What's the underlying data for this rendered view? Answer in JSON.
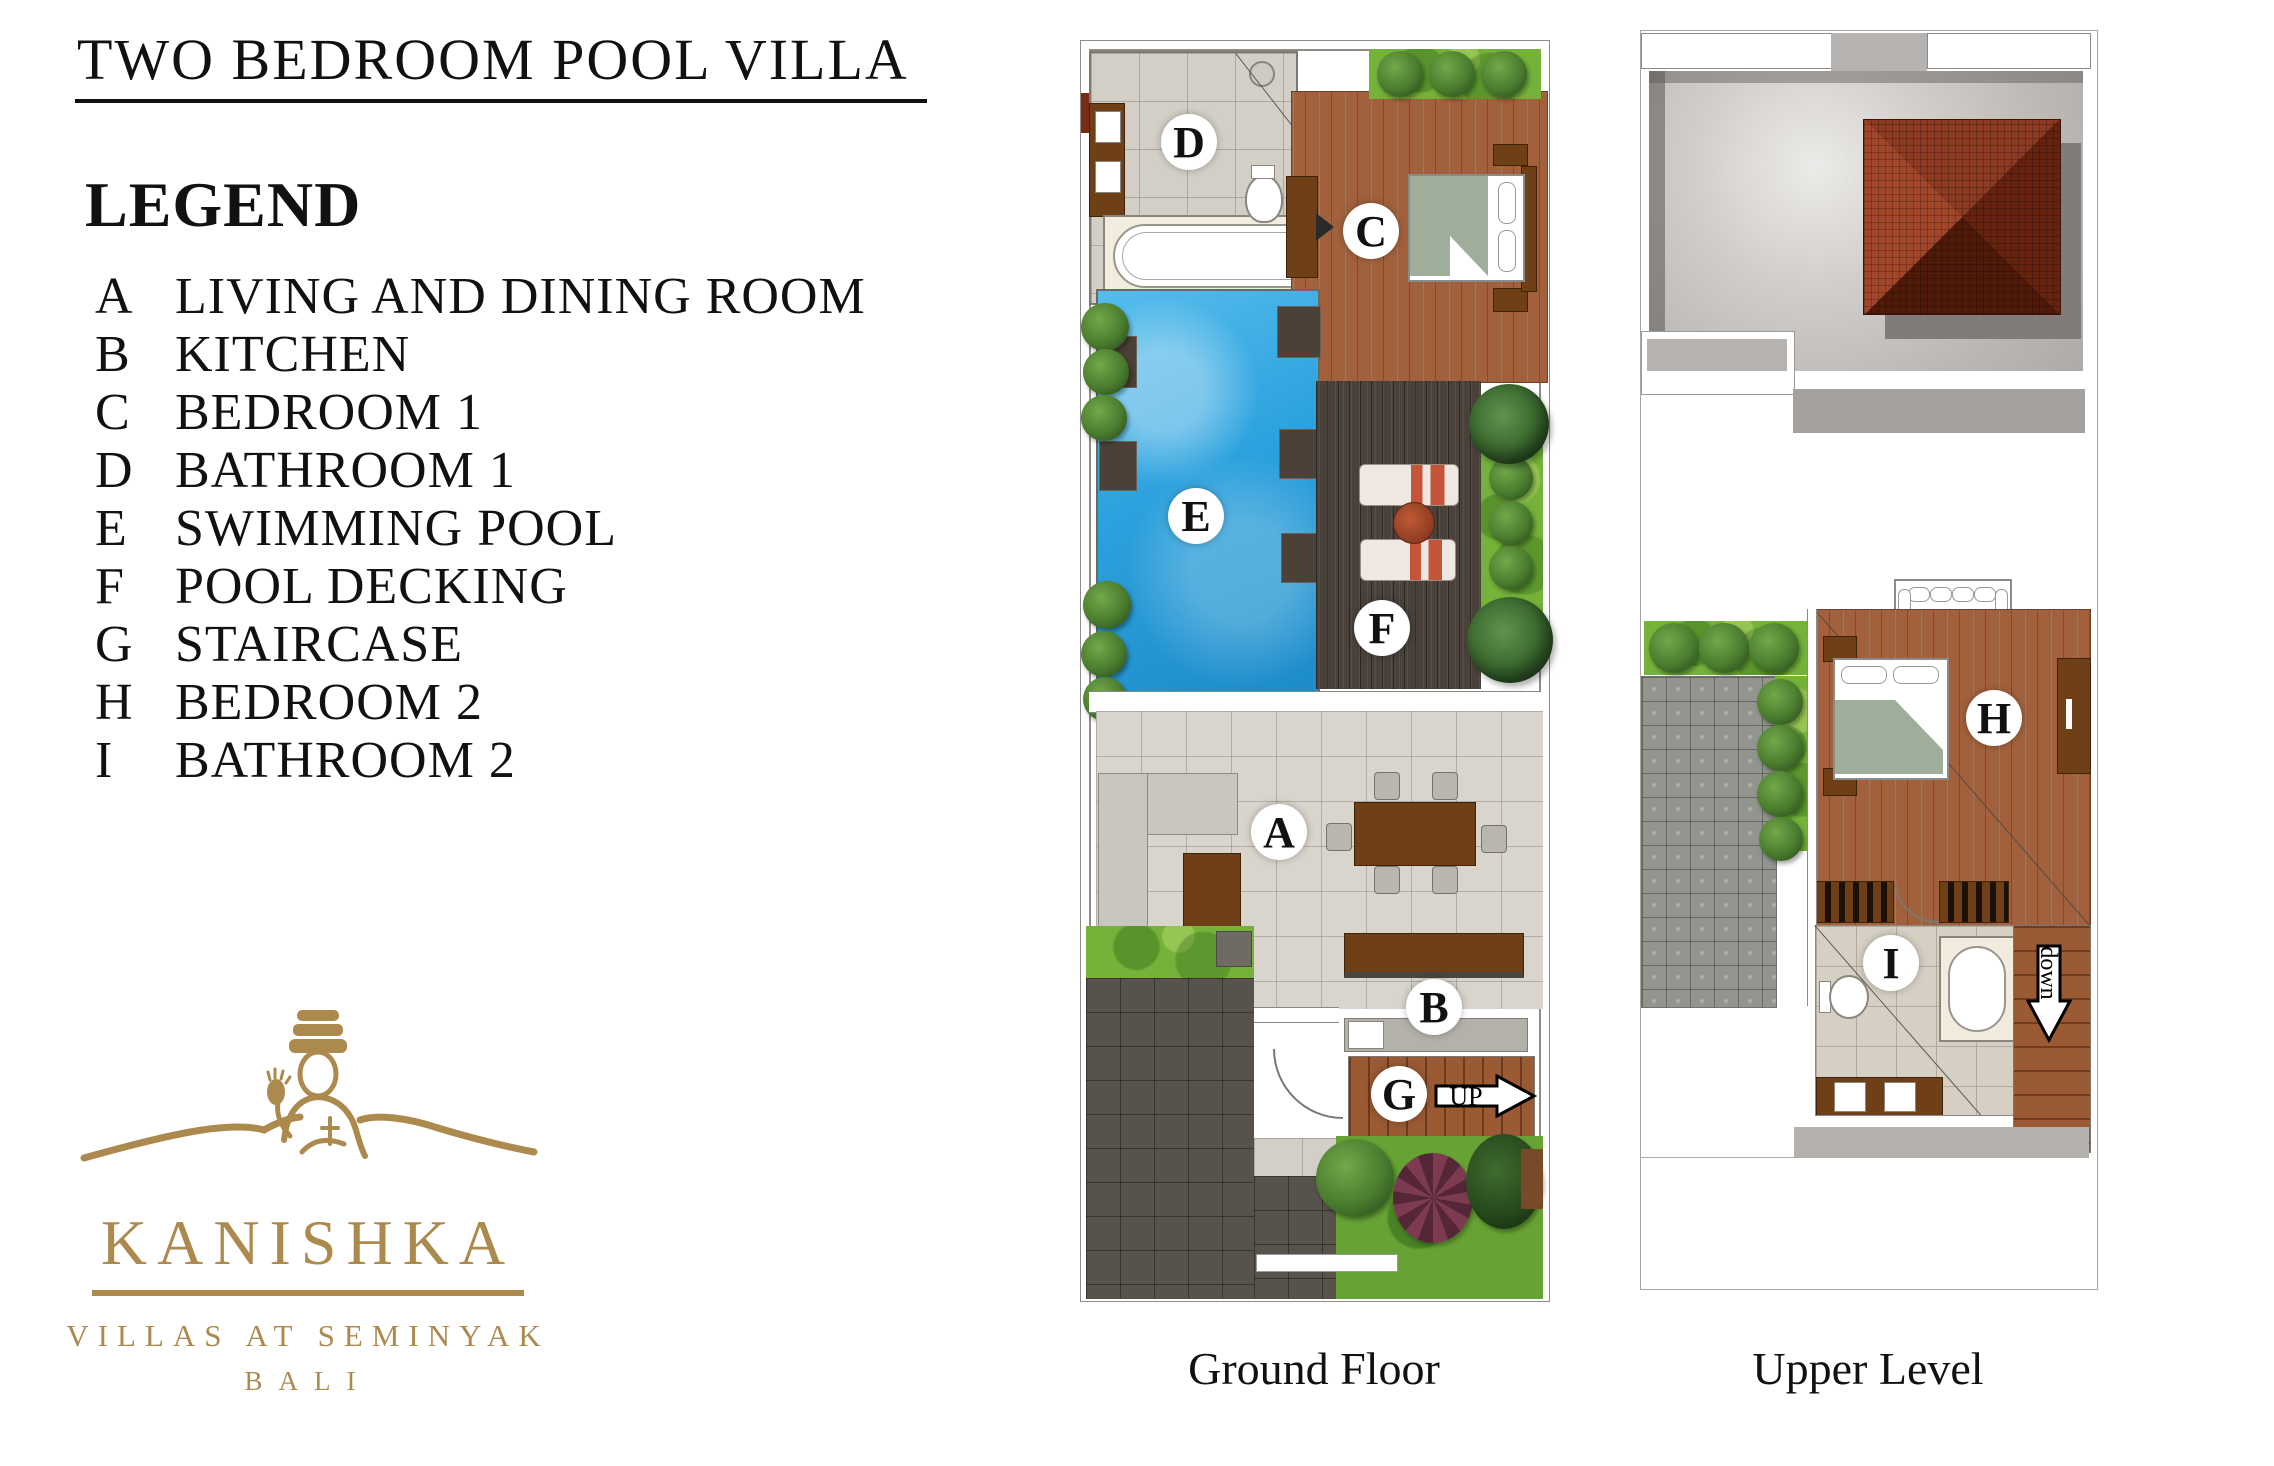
{
  "title": "TWO BEDROOM POOL VILLA",
  "legend": {
    "heading": "LEGEND",
    "items": [
      {
        "key": "A",
        "label": "LIVING AND DINING ROOM"
      },
      {
        "key": "B",
        "label": "KITCHEN"
      },
      {
        "key": "C",
        "label": "BEDROOM 1"
      },
      {
        "key": "D",
        "label": "BATHROOM 1"
      },
      {
        "key": "E",
        "label": "SWIMMING POOL"
      },
      {
        "key": "F",
        "label": "POOL DECKING"
      },
      {
        "key": "G",
        "label": "STAIRCASE"
      },
      {
        "key": "H",
        "label": "BEDROOM 2"
      },
      {
        "key": "I",
        "label": "BATHROOM 2"
      }
    ]
  },
  "logo": {
    "brand": "KANISHKA",
    "tagline": "VILLAS AT SEMINYAK",
    "location": "BALI"
  },
  "plans": {
    "ground": {
      "caption": "Ground Floor",
      "marks": {
        "living": "A",
        "kitchen": "B",
        "bedroom1": "C",
        "bathroom1": "D",
        "pool": "E",
        "deck": "F",
        "stair": "G"
      },
      "stair_direction": "UP"
    },
    "upper": {
      "caption": "Upper Level",
      "marks": {
        "bedroom2": "H",
        "bathroom2": "I"
      },
      "stair_direction": "down"
    }
  },
  "colors": {
    "logo_gold": "#AC8A4E",
    "pool_blue": "#2DA2DE",
    "deck_brown": "#49413A",
    "wood_floor": "#A2613C",
    "tile_gray": "#D9D5CD",
    "grass_green": "#74B23A",
    "roof_red": "#8C3A22",
    "roof_gray": "#C7C3C0",
    "furniture_brown": "#6F4018",
    "text_black": "#111111"
  }
}
